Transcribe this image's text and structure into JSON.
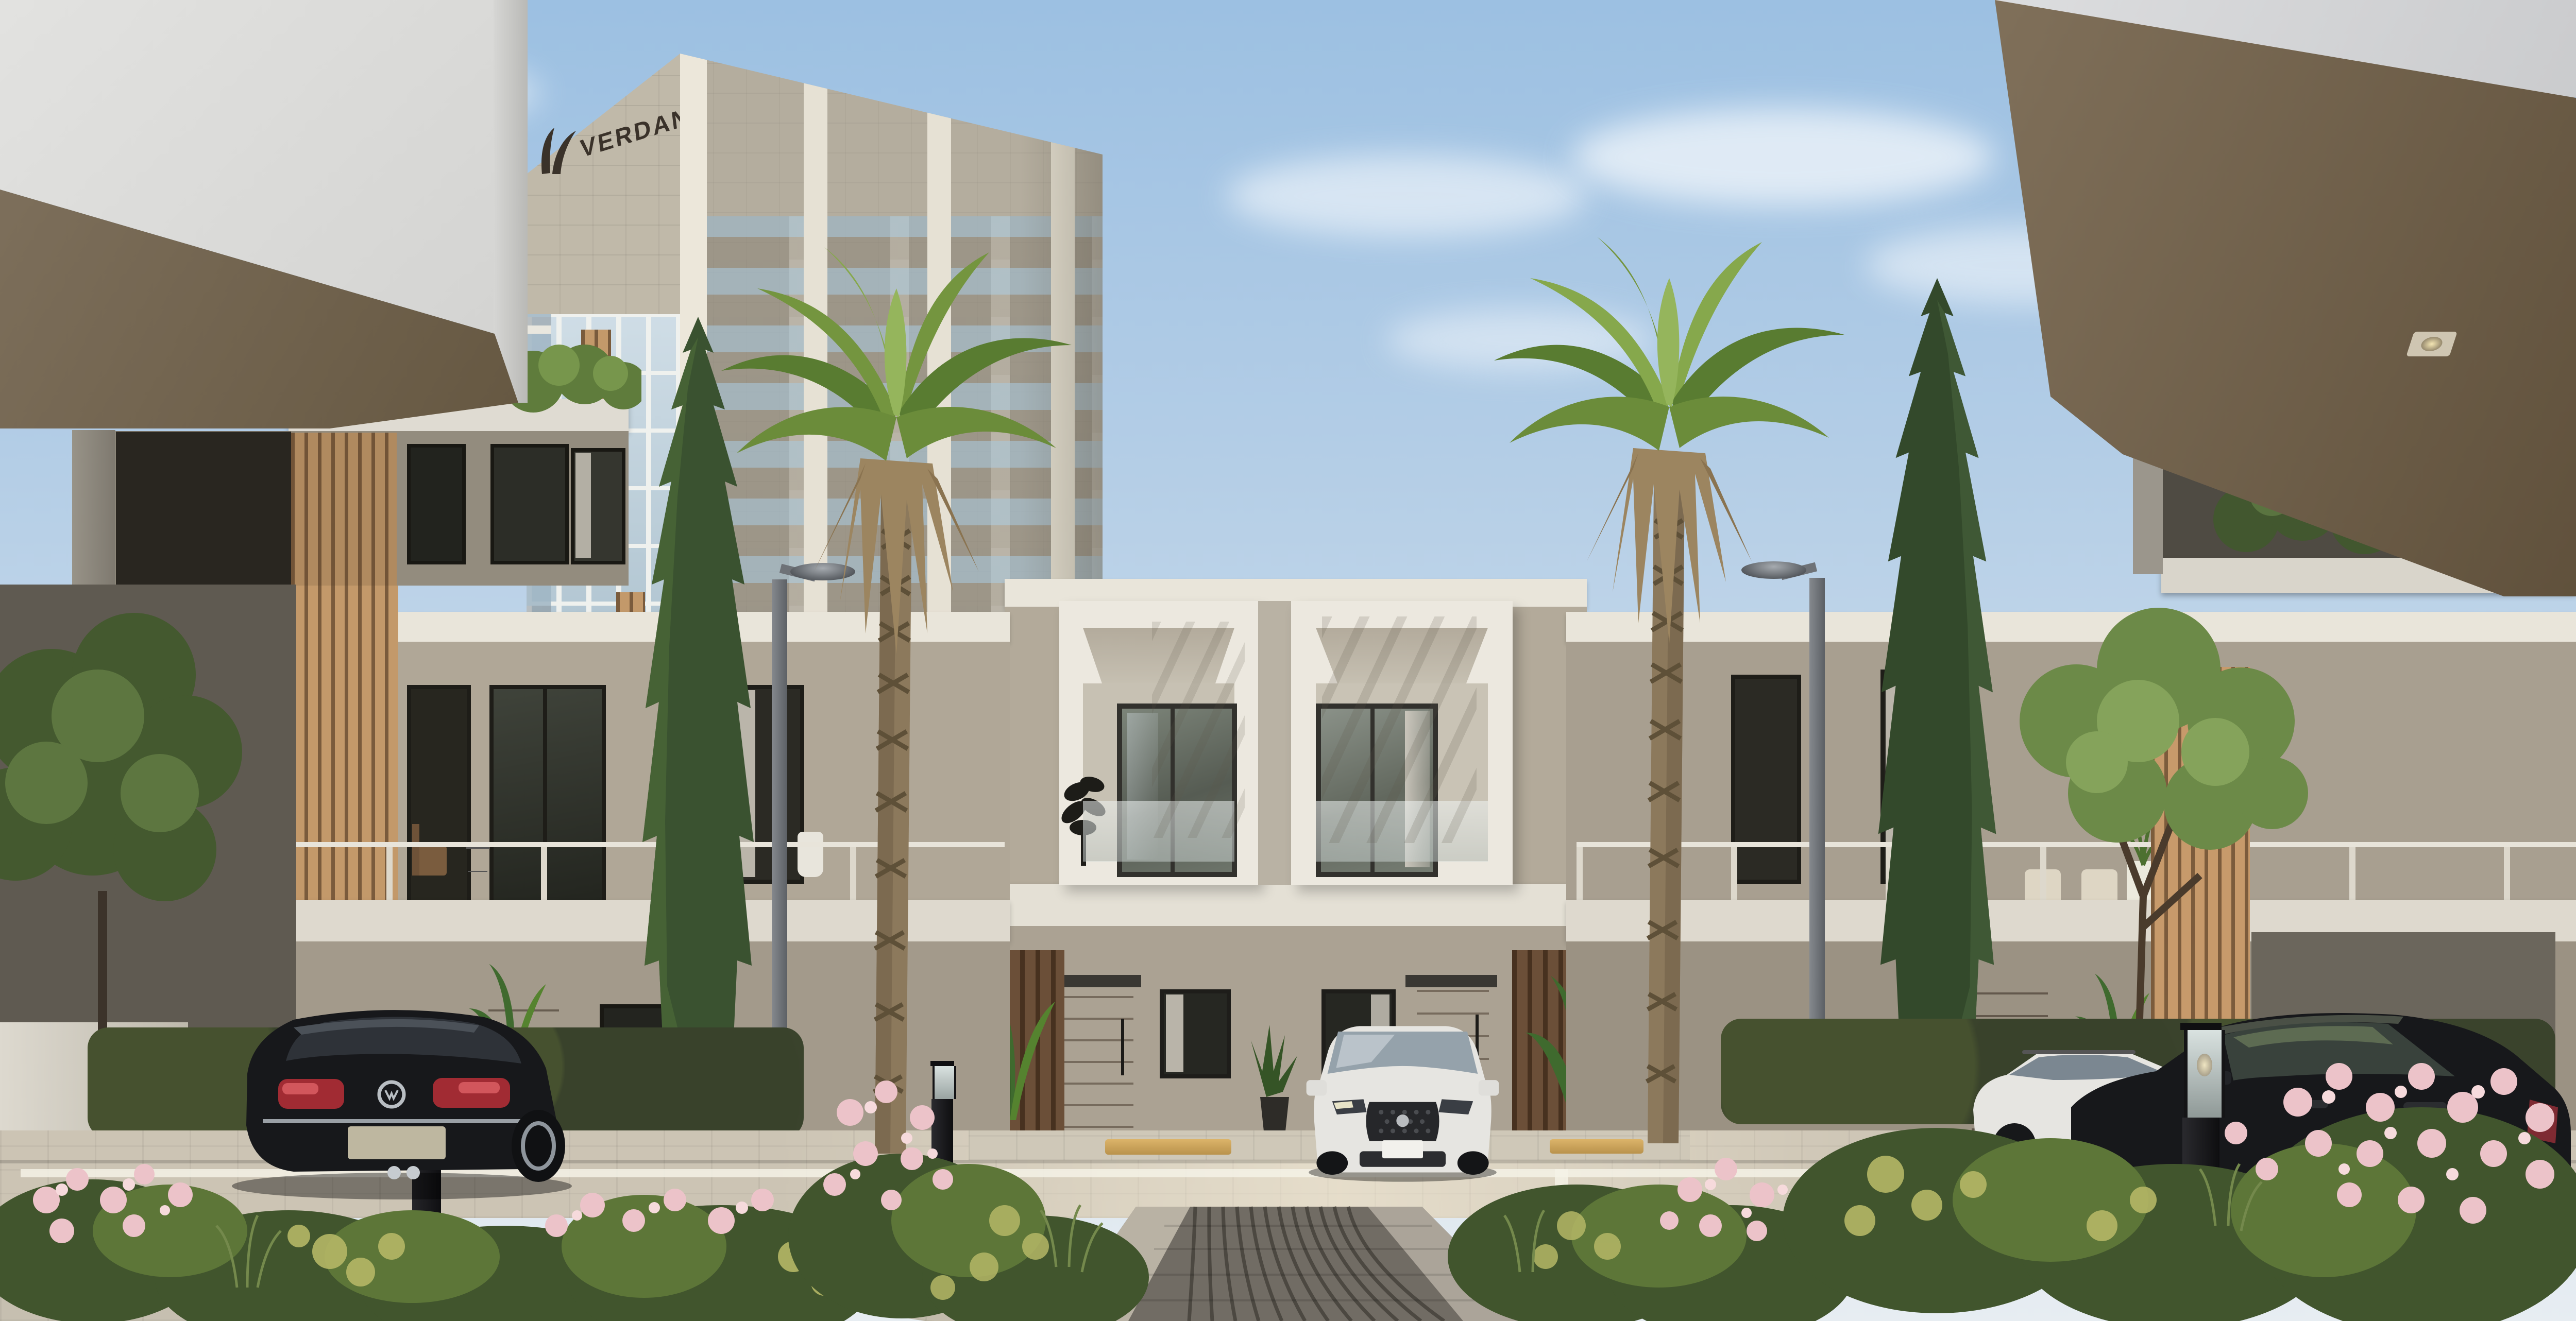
{
  "scene": {
    "kind": "architectural exterior render",
    "development_sign": "VERDANA",
    "description": "Residential courtyard: two-storey townhouses with wood-slat accents framing a cobbled walkway, a VERDANA high-rise tower behind, two tall palms, cypresses, flowering shrubs, street lamps, lantern bollards and parked cars under a blue sky."
  },
  "tower": {
    "sign_text": "VERDANA",
    "logo_icon": "verdana-leaf-logo"
  },
  "objects": {
    "vehicles": [
      "black-sedan-rear-left",
      "white-suv-front-center",
      "white-wagon-right",
      "black-sedan-side-right"
    ],
    "vegetation": [
      "palm-tree-left",
      "palm-tree-right",
      "cypress-left",
      "cypress-right",
      "leafy-tree-left",
      "leafy-tree-right",
      "pink-flower-beds",
      "yellow-green-shrubs",
      "hedges"
    ],
    "street_furniture": [
      "street-lamp-left",
      "street-lamp-right",
      "lantern-bollard-left",
      "lantern-bollard-right",
      "dark-bollard-left",
      "yellow-wheel-stops",
      "white-parking-lines"
    ]
  },
  "colors": {
    "sky-top": "#9cc0e2",
    "sky-low": "#e7edf2",
    "soffit-white": "#dcdcd9",
    "soffit-brown": "#766752",
    "wall-brown": "#6d5f4f",
    "stone": "#c0b9a9",
    "glass": "#c3d4df",
    "mullion": "#eff1ee",
    "pilaster": "#ece7da",
    "wood": "#c3996a",
    "wood-dark": "#6b4f38",
    "stucco": "#b3aa9a",
    "fascia": "#e9e5da",
    "boxwhite": "#ece8df",
    "win-dark": "#32312d",
    "door-wood": "#8a6742",
    "road": "#ccc4b4",
    "cobble": "#716c64",
    "hedge": "#3a432c",
    "cypress": "#3a5230",
    "palm-green": "#74953f",
    "palm-dry": "#9c8560",
    "flower-pink": "#ecc3c9",
    "shrub-yellow": "#b5b766",
    "car-black": "#17181b",
    "car-white": "#e6e5e1",
    "tail-red": "#a12b33",
    "lamp": "#9aa0a6",
    "bollard": "#1b1b1d",
    "wheelstop": "#cfa75e",
    "logo": "#3a322a"
  }
}
